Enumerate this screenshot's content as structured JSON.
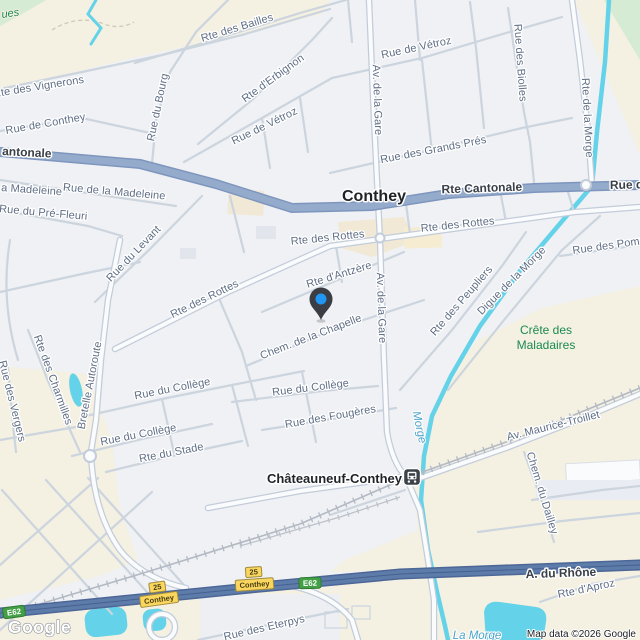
{
  "map": {
    "attribution": "Map data ©2026 Google",
    "logo": "Google",
    "towns": [
      {
        "name": "Conthey"
      },
      {
        "name": "Châteauneuf-Conthey"
      }
    ],
    "streets": [
      {
        "name": "antonale"
      },
      {
        "name": "Rte Cantonale"
      },
      {
        "name": "Rue d"
      },
      {
        "name": "Rte des Bailles"
      },
      {
        "name": "Rte d'Erbignon"
      },
      {
        "name": "Rue de Vétroz"
      },
      {
        "name": "Rue de Vétroz"
      },
      {
        "name": "Rue du Bourg"
      },
      {
        "name": "Rte des Vignerons"
      },
      {
        "name": "Rue de Conthey"
      },
      {
        "name": "Rue des Biolles"
      },
      {
        "name": "Rue des Grands Prés"
      },
      {
        "name": "Rte de la Morge"
      },
      {
        "name": "Av. de la Gare"
      },
      {
        "name": "a Madeleine"
      },
      {
        "name": "Rue de la Madeleine"
      },
      {
        "name": "Rue du Pré-Fleuri"
      },
      {
        "name": "Rue du Levant"
      },
      {
        "name": "Rte des Rottes"
      },
      {
        "name": "Rte des Rottes"
      },
      {
        "name": "Rte des Rottes"
      },
      {
        "name": "Rte d'Antzère"
      },
      {
        "name": "Av. de la Gare"
      },
      {
        "name": "Chem. de la Chapelle"
      },
      {
        "name": "Rte des Peupliers"
      },
      {
        "name": "Digue de la Morge"
      },
      {
        "name": "Rue des Pommiers"
      },
      {
        "name": "Rte des Charmilles"
      },
      {
        "name": "Bretelle Autoroute"
      },
      {
        "name": "Rue des Vergers"
      },
      {
        "name": "Rue du Collège"
      },
      {
        "name": "Rue du Collège"
      },
      {
        "name": "Rue du Collège"
      },
      {
        "name": "Rte du Stade"
      },
      {
        "name": "Rue des Fougères"
      },
      {
        "name": "Av. Maurice-Troillet"
      },
      {
        "name": "Chem. du Dailley"
      },
      {
        "name": "A. du Rhône"
      },
      {
        "name": "Rte d'Aproz"
      },
      {
        "name": "Rue des Eterpys"
      }
    ],
    "areas": [
      {
        "name": "Crête des"
      },
      {
        "name": "Maladaires"
      },
      {
        "name": "ues"
      }
    ],
    "waters": [
      {
        "name": "Morge"
      },
      {
        "name": "La Morge"
      }
    ],
    "shields": {
      "e_road": "E62",
      "route_number": "25",
      "route_name": "Conthey"
    },
    "station": {
      "name": "Châteauneuf-Conthey",
      "type": "train-station"
    },
    "pin": {
      "type": "dropped-pin"
    },
    "colors": {
      "urban": "#eff1f4",
      "terrain": "#f4f0e2",
      "park": "#d5ebd3",
      "water": "#64d2e8",
      "road_major": "#94abcc",
      "motorway": "#5e7caa",
      "road_minor": "#ccd4de",
      "railway": "#b3b9c3",
      "pin_body": "#3a3e44",
      "pin_dot": "#2196f3",
      "shield_green": "#43a047",
      "shield_yellow": "#fbd65f"
    }
  }
}
